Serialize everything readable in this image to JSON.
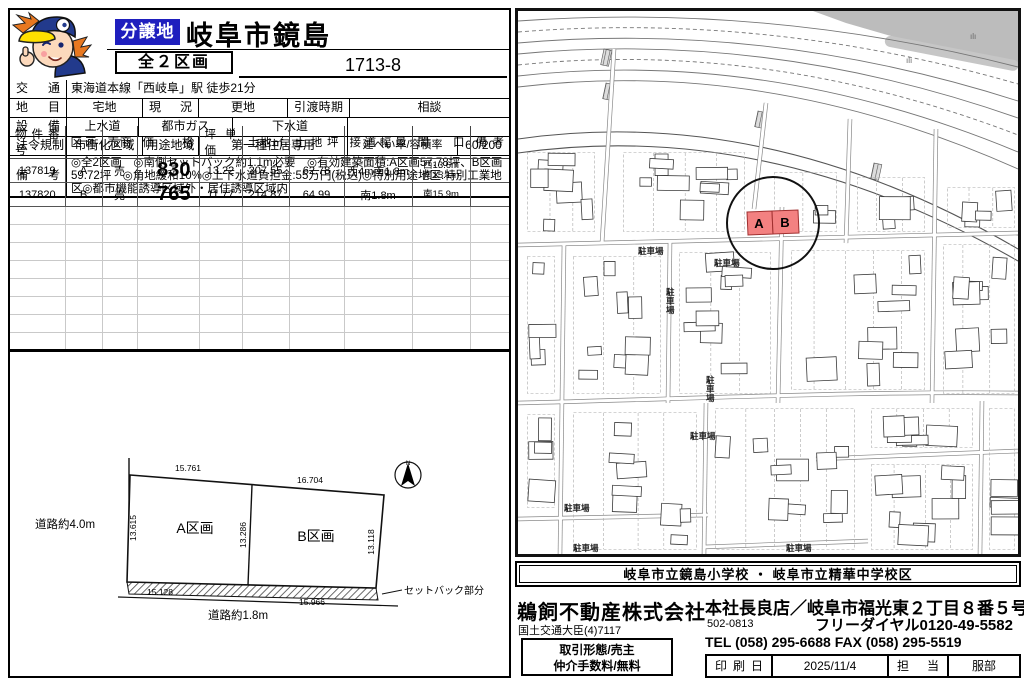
{
  "header": {
    "badge": "分譲地",
    "title": "岐阜市鏡島",
    "lots_label": "全２区画",
    "number": "1713-8"
  },
  "spec": {
    "access_label": "交通",
    "access": "東海道本線「西岐阜」駅  徒歩21分",
    "landcat_label": "地目",
    "landcat": "宅地",
    "status_label": "現況",
    "status": "更地",
    "handover_label": "引渡時期",
    "handover": "相談",
    "util_label": "設備",
    "util1": "上水道",
    "util2": "都市ガス",
    "util3": "下水道",
    "law_label": "法令規制",
    "law1": "市街化区域",
    "zone_label": "用途地域",
    "zone": "第一種住居専用",
    "ratio_label": "建ぺい率/容積率",
    "ratio": "60/200",
    "notes_label": "備考",
    "notes": "◎全2区画　◎南側セットバック約1.1m必要　◎有効建築面積:A区画57.78坪、B区画59.72坪　◎角地緩和10%◎上下水道負担金:55万円(税込)◎特別用途地区:特別工業地区◎都市機能誘導区域外・居住誘導区域内"
  },
  "listing": {
    "headers": [
      "物件番号",
      "区画",
      "売商",
      "価格",
      "坪単価",
      "土地㎡",
      "土地坪",
      "接道幅員",
      "間口",
      "備考"
    ],
    "rows": [
      {
        "no": "137819",
        "lot": "A",
        "sale": "売",
        "price": "830",
        "unit": "13.22",
        "sqm": "207.55",
        "tsubo": "62.78",
        "road": "西4m南1.8m",
        "frontage": "西13.6m\n南15.1m",
        "note": ""
      },
      {
        "no": "137820",
        "lot": "B",
        "sale": "売",
        "price": "765",
        "unit": "11.77",
        "sqm": "214.87",
        "tsubo": "64.99",
        "road": "南1.8m",
        "frontage": "南15.9m",
        "note": ""
      }
    ],
    "empty_rows": 8
  },
  "diagram": {
    "a_label": "A区画",
    "b_label": "B区画",
    "road_left": "道路約4.0m",
    "road_bottom": "道路約1.8m",
    "setback": "セットバック部分",
    "north": "N",
    "dim_a_top": "15.761",
    "dim_b_top": "16.704",
    "dim_a_left": "13.615",
    "dim_mid": "13.286",
    "dim_b_right": "13.118",
    "dim_a_bottom": "15.128",
    "dim_b_bottom": "15.966"
  },
  "map": {
    "lot_a": "A",
    "lot_b": "B",
    "parking_label": "駐車場"
  },
  "school": "岐阜市立鏡島小学校 ・ 岐阜市立精華中学校区",
  "company": {
    "name": "鵜飼不動産株式会社",
    "license": "国土交通大臣(4)7117",
    "deal_line1": "取引形態/売主",
    "deal_line2": "仲介手数料/無料",
    "branch": "本社長良店／岐阜市福光東２丁目８番５号",
    "postal": "502-0813",
    "freedial": "フリーダイヤル0120-49-5582",
    "tel": "TEL (058) 295-6688  FAX (058) 295-5519",
    "print_label": "印刷日",
    "print_date": "2025/11/4",
    "staff_label": "担当",
    "staff_name": "服部"
  }
}
